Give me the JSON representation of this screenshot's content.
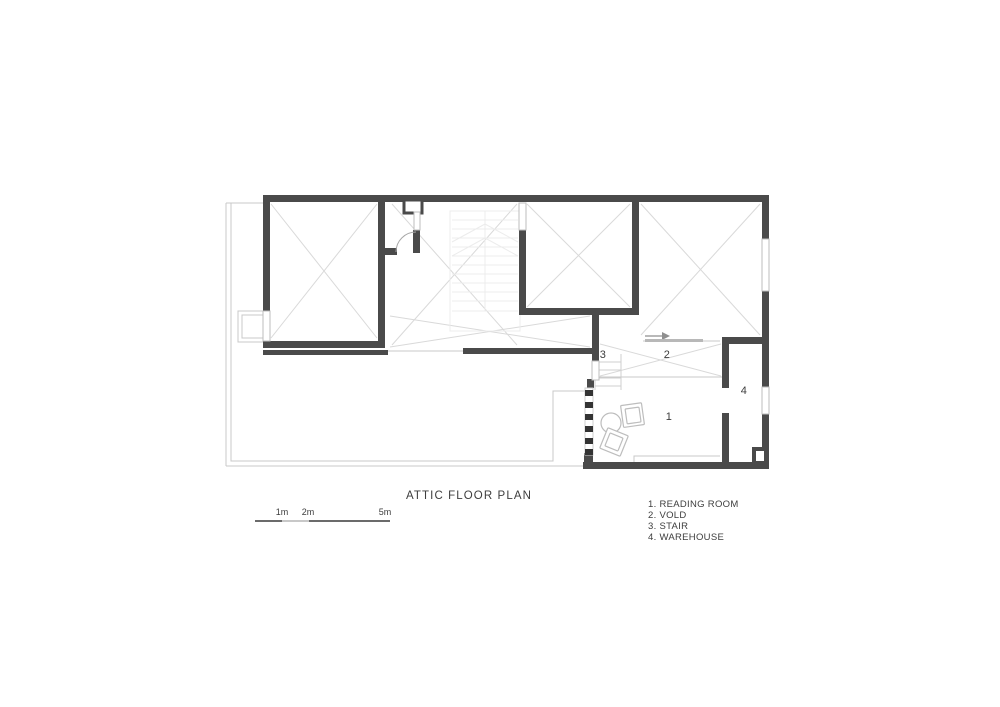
{
  "drawing": {
    "title": "ATTIC FLOOR PLAN",
    "room_numbers": {
      "reading_room": "1",
      "void": "2",
      "stair": "3",
      "warehouse": "4"
    },
    "legend_items": [
      "1. READING ROOM",
      "2. VOLD",
      "3. STAIR",
      "4. WAREHOUSE"
    ],
    "scale_labels": [
      "1m",
      "2m",
      "5m"
    ]
  },
  "colors": {
    "wall": "#4a4a4a",
    "window_line": "#bdbdbd",
    "thin_line": "#c8c8c8",
    "cross_line": "#d9d9d9",
    "faint_line": "#ececec",
    "small_stair_line": "#cfcfcf",
    "furniture_line": "#bdbdbd",
    "text": "#3d3d3d",
    "background": "#ffffff"
  }
}
